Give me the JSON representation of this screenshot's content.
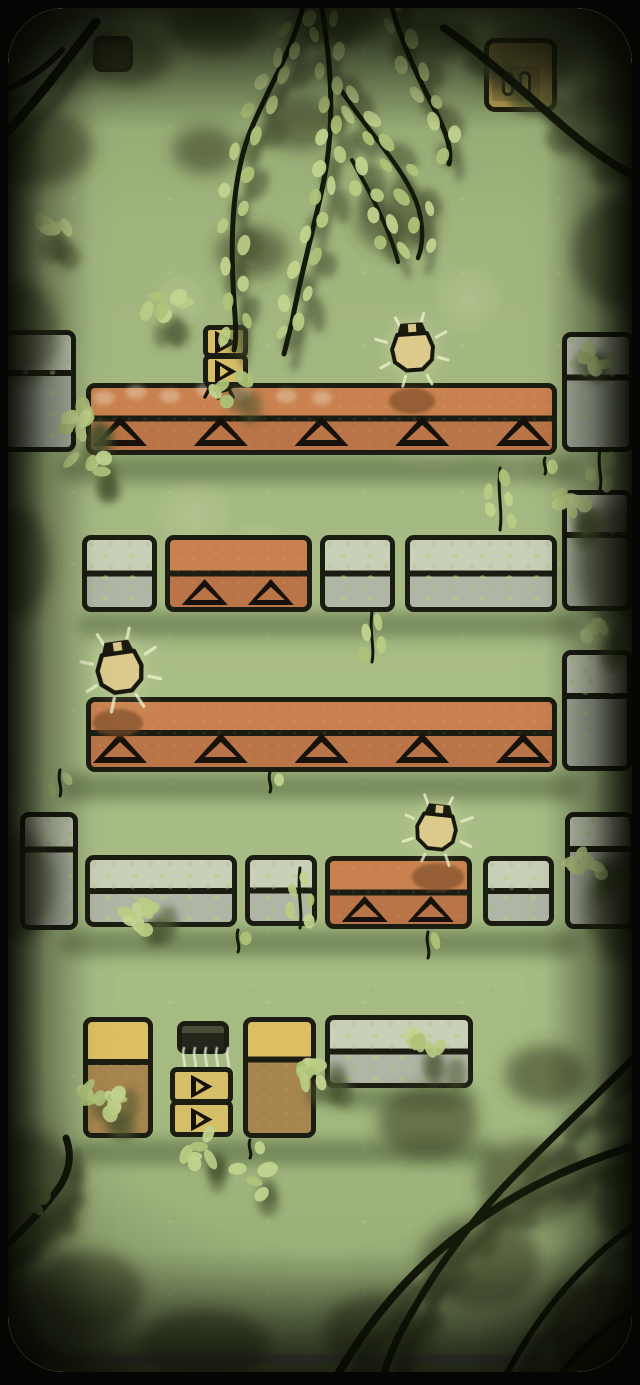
{
  "scene": {
    "kind": "forest-block-puzzle-level",
    "background_color": "#a4b981"
  },
  "colors": {
    "outline": "#1c1d12",
    "platform_top": "#c9824f",
    "platform_bottom": "#b97547",
    "stone_top": "#c9d0b8",
    "stone_bottom": "#afb6a5",
    "yellow_box": "#d6bd68",
    "dresser_top": "#ddbf63",
    "dresser_bottom": "#a6854e",
    "dark_box_top": "#4a4e38",
    "dark_box_bottom": "#23261a",
    "firefly_body": "#dcc98c",
    "leaf_bright": "#b9cc84",
    "leaf_alt": "#aec378",
    "leaf_pale": "#c2d48f",
    "leaf_shadow": "#45502e",
    "branch": "#141a0a",
    "branch_shadow": "#39422a"
  },
  "hud": {
    "pause_button": {
      "x": 93,
      "y": 36,
      "w": 40,
      "h": 36
    },
    "firefly_counter": {
      "x": 484,
      "y": 38,
      "w": 73,
      "h": 74,
      "slots": 2
    }
  },
  "home_indicator": {
    "x": 76,
    "y": 1354,
    "w": 488,
    "h": 9
  },
  "level": {
    "objects": [
      {
        "type": "edge",
        "x": 2,
        "y": 330,
        "w": 74,
        "h": 122,
        "divider": 0.34
      },
      {
        "type": "edge",
        "x": 562,
        "y": 332,
        "w": 72,
        "h": 120,
        "divider": 0.37
      },
      {
        "type": "platform",
        "x": 86,
        "y": 383,
        "w": 471,
        "h": 72,
        "triangles": 5,
        "divider": 0.49,
        "wear": true
      },
      {
        "type": "bug",
        "x": 196,
        "y": 368
      },
      {
        "type": "playstack",
        "x": 203,
        "y": 325,
        "w": 45,
        "box_h": 31,
        "count": 2
      },
      {
        "type": "stone",
        "x": 82,
        "y": 535,
        "w": 75,
        "h": 77
      },
      {
        "type": "pad",
        "x": 165,
        "y": 535,
        "w": 147,
        "h": 77,
        "triangles": 2,
        "divider": 0.5
      },
      {
        "type": "stone",
        "x": 320,
        "y": 535,
        "w": 75,
        "h": 77
      },
      {
        "type": "stone",
        "x": 405,
        "y": 535,
        "w": 152,
        "h": 77
      },
      {
        "type": "edge",
        "x": 562,
        "y": 490,
        "w": 70,
        "h": 121,
        "divider": 0.36
      },
      {
        "type": "platform",
        "x": 86,
        "y": 697,
        "w": 471,
        "h": 75,
        "triangles": 5,
        "divider": 0.48
      },
      {
        "type": "edge",
        "x": 562,
        "y": 650,
        "w": 70,
        "h": 121,
        "divider": 0.37
      },
      {
        "type": "edge",
        "x": 20,
        "y": 812,
        "w": 58,
        "h": 118,
        "divider": 0.3
      },
      {
        "type": "stone",
        "x": 85,
        "y": 855,
        "w": 152,
        "h": 72
      },
      {
        "type": "stone",
        "x": 245,
        "y": 855,
        "w": 72,
        "h": 71
      },
      {
        "type": "pad",
        "x": 325,
        "y": 856,
        "w": 147,
        "h": 73,
        "triangles": 2,
        "divider": 0.5
      },
      {
        "type": "stone",
        "x": 483,
        "y": 856,
        "w": 71,
        "h": 70
      },
      {
        "type": "edge",
        "x": 565,
        "y": 812,
        "w": 70,
        "h": 117,
        "divider": 0.3
      },
      {
        "type": "dresser",
        "x": 83,
        "y": 1017,
        "w": 70,
        "h": 121,
        "divider": 0.36
      },
      {
        "type": "darkbox",
        "x": 177,
        "y": 1021,
        "w": 52,
        "h": 33
      },
      {
        "type": "steam",
        "x": 178,
        "y": 1046,
        "w": 56,
        "h": 30
      },
      {
        "type": "playstack",
        "x": 170,
        "y": 1067,
        "w": 63,
        "box_h": 35,
        "count": 2
      },
      {
        "type": "dresser",
        "x": 243,
        "y": 1017,
        "w": 73,
        "h": 121,
        "divider": 0.34
      },
      {
        "type": "stone",
        "x": 325,
        "y": 1015,
        "w": 148,
        "h": 73
      }
    ],
    "fireflies": [
      {
        "cx": 413,
        "cy": 350,
        "s": 1.0,
        "r": -4
      },
      {
        "cx": 120,
        "cy": 670,
        "s": 1.08,
        "r": -8
      },
      {
        "cx": 437,
        "cy": 830,
        "s": 0.95,
        "r": 6
      }
    ],
    "shadow_spots": [
      {
        "cx": 412,
        "cy": 401,
        "rx": 23,
        "ry": 13
      },
      {
        "cx": 118,
        "cy": 723,
        "rx": 25,
        "ry": 14
      },
      {
        "cx": 438,
        "cy": 877,
        "rx": 26,
        "ry": 14
      }
    ],
    "ground_shadows": [
      {
        "x": 60,
        "y": 456,
        "w": 520,
        "h": 26
      },
      {
        "x": 80,
        "y": 613,
        "w": 500,
        "h": 24
      },
      {
        "x": 60,
        "y": 774,
        "w": 520,
        "h": 26
      },
      {
        "x": 60,
        "y": 930,
        "w": 520,
        "h": 26
      },
      {
        "x": 80,
        "y": 1140,
        "w": 420,
        "h": 24
      },
      {
        "x": 325,
        "y": 1088,
        "w": 150,
        "h": 20
      }
    ],
    "wear_spots": [
      {
        "cx": 104,
        "cy": 398
      },
      {
        "cx": 136,
        "cy": 392
      },
      {
        "cx": 170,
        "cy": 396
      },
      {
        "cx": 206,
        "cy": 390
      },
      {
        "cx": 242,
        "cy": 394
      },
      {
        "cx": 286,
        "cy": 396
      },
      {
        "cx": 322,
        "cy": 398
      }
    ]
  },
  "decor": {
    "branches": [
      {
        "d": "M303,6 C293,50 266,92 250,132 C236,168 230,218 233,282 C234,312 238,334 234,350",
        "w": 5,
        "leaves": true
      },
      {
        "d": "M322,10 C331,62 334,112 327,162 C320,208 303,262 292,322 C288,338 286,346 284,354",
        "w": 5,
        "leaves": true
      },
      {
        "d": "M389,-4 C399,38 418,78 436,112 C448,136 452,152 449,164",
        "w": 5,
        "leaves": true
      },
      {
        "d": "M341,90 C364,126 395,158 412,192 C423,214 425,240 418,258",
        "w": 4.5,
        "leaves": true
      },
      {
        "d": "M352,160 C372,196 390,230 398,262",
        "w": 4,
        "leaves": true
      },
      {
        "d": "M-12,152 C28,112 58,72 96,22",
        "w": 9,
        "leaves": false,
        "shadow_leaves": false
      },
      {
        "d": "M-10,96 C20,86 44,70 62,50",
        "w": 6,
        "leaves": false,
        "shadow_leaves": false
      },
      {
        "d": "M444,28 C482,54 522,90 556,120 C592,152 620,170 650,184",
        "w": 8,
        "leaves": false,
        "shadow_leaves": true
      },
      {
        "d": "M328,1392 C360,1332 402,1280 452,1240 C502,1200 562,1166 648,1142",
        "w": 8,
        "leaves": false,
        "shadow_leaves": true
      },
      {
        "d": "M644,1048 C602,1090 560,1130 520,1170 C480,1210 440,1262 412,1312 C396,1338 386,1362 380,1390",
        "w": 7,
        "leaves": false,
        "shadow_leaves": true
      },
      {
        "d": "M498,1392 C520,1344 550,1302 586,1266 C610,1242 630,1227 650,1216",
        "w": 6,
        "leaves": false,
        "shadow_leaves": true
      },
      {
        "d": "M646,1300 C614,1320 582,1346 558,1378",
        "w": 6,
        "leaves": false,
        "shadow_leaves": true
      },
      {
        "d": "M-12,1262 C22,1232 46,1206 60,1186 C70,1170 72,1154 66,1138",
        "w": 7,
        "leaves": false,
        "shadow_leaves": true
      }
    ],
    "sprigs": [
      {
        "x": 500,
        "y": 468,
        "len": 62,
        "n": 7
      },
      {
        "x": 270,
        "y": 772,
        "len": 20,
        "n": 3
      },
      {
        "x": 545,
        "y": 458,
        "len": 16,
        "n": 3
      },
      {
        "x": 238,
        "y": 930,
        "len": 22,
        "n": 4
      },
      {
        "x": 428,
        "y": 932,
        "len": 26,
        "n": 4
      },
      {
        "x": 250,
        "y": 1140,
        "len": 18,
        "n": 3
      },
      {
        "x": 600,
        "y": 450,
        "len": 40,
        "n": 6
      },
      {
        "x": 60,
        "y": 770,
        "len": 26,
        "n": 4
      },
      {
        "x": 372,
        "y": 612,
        "len": 50,
        "n": 7
      },
      {
        "x": 300,
        "y": 868,
        "len": 60,
        "n": 8
      }
    ],
    "leaf_clusters": [
      {
        "x": 46,
        "y": 226,
        "n": 6
      },
      {
        "x": 168,
        "y": 312,
        "n": 6
      },
      {
        "x": 82,
        "y": 420,
        "n": 9
      },
      {
        "x": 92,
        "y": 464,
        "n": 5
      },
      {
        "x": 572,
        "y": 502,
        "n": 8
      },
      {
        "x": 586,
        "y": 356,
        "n": 5
      },
      {
        "x": 148,
        "y": 912,
        "n": 8
      },
      {
        "x": 585,
        "y": 862,
        "n": 7
      },
      {
        "x": 100,
        "y": 1098,
        "n": 9
      },
      {
        "x": 312,
        "y": 1068,
        "n": 9
      },
      {
        "x": 200,
        "y": 1146,
        "n": 6
      },
      {
        "x": 418,
        "y": 1046,
        "n": 6
      },
      {
        "x": 40,
        "y": 1196,
        "n": 7,
        "dark": true
      },
      {
        "x": 256,
        "y": 1178,
        "n": 4
      },
      {
        "x": 598,
        "y": 624,
        "n": 4
      },
      {
        "x": 230,
        "y": 386,
        "n": 4
      }
    ],
    "shadow_blobs": [
      {
        "x": 38,
        "y": 148,
        "rx": 55,
        "ry": 38
      },
      {
        "x": 128,
        "y": 58,
        "rx": 42,
        "ry": 28
      },
      {
        "x": 215,
        "y": 28,
        "rx": 48,
        "ry": 26
      },
      {
        "x": 335,
        "y": 22,
        "rx": 44,
        "ry": 24
      },
      {
        "x": 430,
        "y": 40,
        "rx": 36,
        "ry": 22
      },
      {
        "x": 524,
        "y": 62,
        "rx": 50,
        "ry": 36
      },
      {
        "x": 612,
        "y": 125,
        "rx": 55,
        "ry": 42
      },
      {
        "x": 618,
        "y": 252,
        "rx": 45,
        "ry": 55
      },
      {
        "x": 300,
        "y": 124,
        "rx": 36,
        "ry": 26
      },
      {
        "x": 396,
        "y": 222,
        "rx": 40,
        "ry": 30
      },
      {
        "x": 252,
        "y": 252,
        "rx": 36,
        "ry": 26
      },
      {
        "x": 205,
        "y": 150,
        "rx": 32,
        "ry": 24
      },
      {
        "x": 22,
        "y": 332,
        "rx": 36,
        "ry": 50
      },
      {
        "x": 18,
        "y": 562,
        "rx": 32,
        "ry": 55
      },
      {
        "x": 615,
        "y": 565,
        "rx": 36,
        "ry": 62
      },
      {
        "x": 18,
        "y": 885,
        "rx": 36,
        "ry": 55
      },
      {
        "x": 622,
        "y": 905,
        "rx": 36,
        "ry": 55
      },
      {
        "x": 28,
        "y": 1192,
        "rx": 50,
        "ry": 62
      },
      {
        "x": 88,
        "y": 1292,
        "rx": 55,
        "ry": 42
      },
      {
        "x": 205,
        "y": 1345,
        "rx": 65,
        "ry": 36
      },
      {
        "x": 428,
        "y": 1122,
        "rx": 50,
        "ry": 36
      },
      {
        "x": 532,
        "y": 1182,
        "rx": 55,
        "ry": 42
      },
      {
        "x": 480,
        "y": 1262,
        "rx": 60,
        "ry": 46
      },
      {
        "x": 378,
        "y": 1332,
        "rx": 55,
        "ry": 38
      },
      {
        "x": 592,
        "y": 1322,
        "rx": 55,
        "ry": 46
      },
      {
        "x": 545,
        "y": 1075,
        "rx": 40,
        "ry": 30
      },
      {
        "x": 628,
        "y": 1190,
        "rx": 40,
        "ry": 50
      }
    ],
    "bokeh": [
      {
        "cx": 195,
        "cy": 515,
        "r": 42
      },
      {
        "cx": 258,
        "cy": 552,
        "r": 34
      },
      {
        "cx": 430,
        "cy": 438,
        "r": 44
      },
      {
        "cx": 468,
        "cy": 300,
        "r": 38
      },
      {
        "cx": 515,
        "cy": 468,
        "r": 26
      },
      {
        "cx": 180,
        "cy": 300,
        "r": 30
      }
    ]
  }
}
